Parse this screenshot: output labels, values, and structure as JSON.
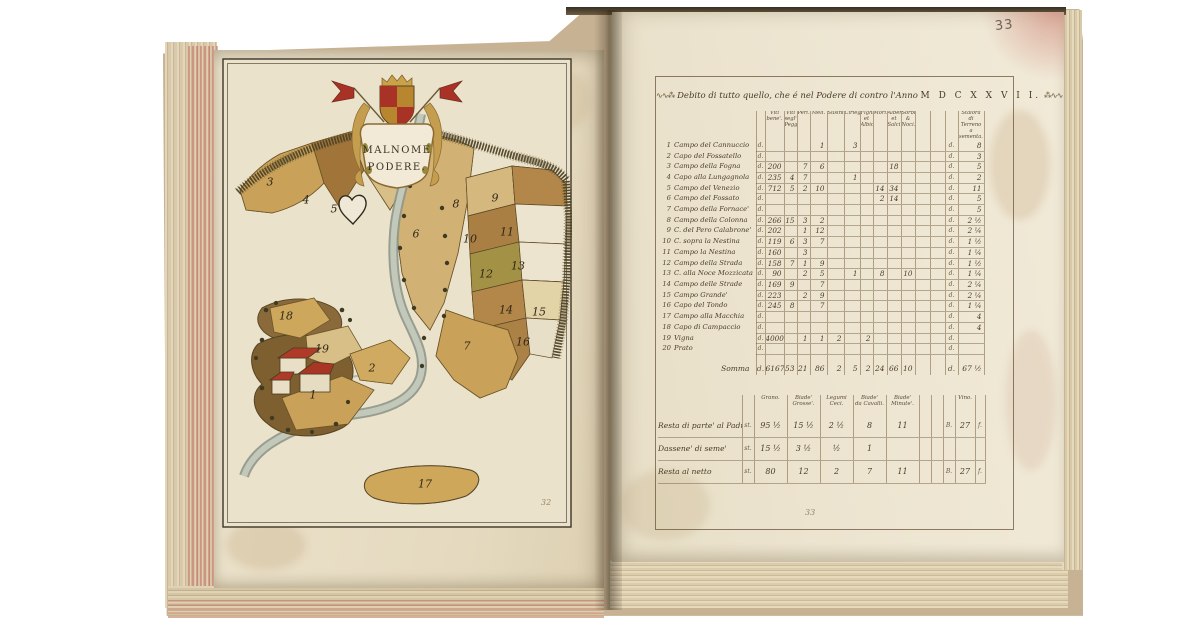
{
  "book": {
    "folio_top_right": "33",
    "left_page_number": "32",
    "right_page_number": "33"
  },
  "map_page": {
    "cartouche": {
      "line1": "MALNOME",
      "line2": "PODERE."
    },
    "field_numbers": [
      {
        "n": "1",
        "x": 91,
        "y": 337
      },
      {
        "n": "2",
        "x": 150,
        "y": 310
      },
      {
        "n": "3",
        "x": 48,
        "y": 124
      },
      {
        "n": "4",
        "x": 84,
        "y": 142
      },
      {
        "n": "5",
        "x": 112,
        "y": 151
      },
      {
        "n": "6",
        "x": 194,
        "y": 176
      },
      {
        "n": "7",
        "x": 245,
        "y": 288
      },
      {
        "n": "8",
        "x": 234,
        "y": 146
      },
      {
        "n": "9",
        "x": 273,
        "y": 140
      },
      {
        "n": "10",
        "x": 248,
        "y": 181
      },
      {
        "n": "11",
        "x": 285,
        "y": 174
      },
      {
        "n": "12",
        "x": 264,
        "y": 216
      },
      {
        "n": "13",
        "x": 296,
        "y": 208
      },
      {
        "n": "14",
        "x": 284,
        "y": 252
      },
      {
        "n": "15",
        "x": 317,
        "y": 254
      },
      {
        "n": "16",
        "x": 301,
        "y": 284
      },
      {
        "n": "17",
        "x": 203,
        "y": 426
      },
      {
        "n": "18",
        "x": 64,
        "y": 258
      },
      {
        "n": "19",
        "x": 100,
        "y": 291
      }
    ]
  },
  "ledger_page": {
    "title": {
      "flourish_left": "∿∿⁂",
      "text": "Debito di tutto quello, che é nel Podere di contro l'Anno",
      "year": "M D C X X V I I.",
      "flourish_right": "⁂∿∿"
    },
    "unit_mark": "d.",
    "columns": [
      "Viti\nbene'.",
      "Viti segl'\nPegg.",
      "Peri.",
      "Meli.",
      "Susini.",
      "Ciriegi.",
      "Fighi, et\nAlbicocchi.",
      "Mori.",
      "Alberi,\net Salci.",
      "Sorbi,\n& Noci.",
      "",
      "Staiora di\nTerreno a\nsementa."
    ],
    "rows": [
      {
        "n": "1",
        "label": "Campo del Cannuccio",
        "v": [
          "",
          "",
          "",
          "1",
          "",
          "3",
          "",
          "",
          "",
          "",
          "",
          "8"
        ]
      },
      {
        "n": "2",
        "label": "Capo del Fossatello",
        "v": [
          "",
          "",
          "",
          "",
          "",
          "",
          "",
          "",
          "",
          "",
          "",
          "3"
        ]
      },
      {
        "n": "3",
        "label": "Campo della Fogna",
        "v": [
          "200",
          "",
          "7",
          "6",
          "",
          "",
          "",
          "",
          "18",
          "",
          "",
          "5"
        ]
      },
      {
        "n": "4",
        "label": "Capo alla Lungagnola",
        "v": [
          "235",
          "4",
          "7",
          "",
          "",
          "1",
          "",
          "",
          "",
          "",
          "",
          "2"
        ]
      },
      {
        "n": "5",
        "label": "Campo del Venezio",
        "v": [
          "712",
          "5",
          "2",
          "10",
          "",
          "",
          "",
          "14",
          "34",
          "",
          "",
          "11"
        ]
      },
      {
        "n": "6",
        "label": "Campo del Fossato",
        "v": [
          "",
          "",
          "",
          "",
          "",
          "",
          "",
          "2",
          "14",
          "",
          "",
          "5"
        ]
      },
      {
        "n": "7",
        "label": "Campo della Fornace'",
        "v": [
          "",
          "",
          "",
          "",
          "",
          "",
          "",
          "",
          "",
          "",
          "",
          "5"
        ]
      },
      {
        "n": "8",
        "label": "Campo della Colonna",
        "v": [
          "266",
          "15",
          "3",
          "2",
          "",
          "",
          "",
          "",
          "",
          "",
          "",
          "2 ½"
        ]
      },
      {
        "n": "9",
        "label": "C. del Pero Calabrone'",
        "v": [
          "202",
          "",
          "1",
          "12",
          "",
          "",
          "",
          "",
          "",
          "",
          "",
          "2 ¼"
        ]
      },
      {
        "n": "10",
        "label": "C. sopra la Nestina",
        "v": [
          "119",
          "6",
          "3",
          "7",
          "",
          "",
          "",
          "",
          "",
          "",
          "",
          "1 ½"
        ]
      },
      {
        "n": "11",
        "label": "Campo la Nestina",
        "v": [
          "160",
          "",
          "3",
          "",
          "",
          "",
          "",
          "",
          "",
          "",
          "",
          "1 ¼"
        ]
      },
      {
        "n": "12",
        "label": "Campo della Strada",
        "v": [
          "158",
          "7",
          "1",
          "9",
          "",
          "",
          "",
          "",
          "",
          "",
          "",
          "1 ½"
        ]
      },
      {
        "n": "13",
        "label": "C. alla Noce Mozzicata",
        "v": [
          "90",
          "",
          "2",
          "5",
          "",
          "1",
          "",
          "8",
          "",
          "10",
          "",
          "1 ¼"
        ]
      },
      {
        "n": "14",
        "label": "Campo delle Strade",
        "v": [
          "169",
          "9",
          "",
          "7",
          "",
          "",
          "",
          "",
          "",
          "",
          "",
          "2 ¼"
        ]
      },
      {
        "n": "15",
        "label": "Campo Grande'",
        "v": [
          "223",
          "",
          "2",
          "9",
          "",
          "",
          "",
          "",
          "",
          "",
          "",
          "2 ¼"
        ]
      },
      {
        "n": "16",
        "label": "Capo del Tondo",
        "v": [
          "245",
          "8",
          "",
          "7",
          "",
          "",
          "",
          "",
          "",
          "",
          "",
          "1 ¼"
        ]
      },
      {
        "n": "17",
        "label": "Campo alla Macchia",
        "v": [
          "",
          "",
          "",
          "",
          "",
          "",
          "",
          "",
          "",
          "",
          "",
          "4"
        ]
      },
      {
        "n": "18",
        "label": "Capo di Campaccio",
        "v": [
          "",
          "",
          "",
          "",
          "",
          "",
          "",
          "",
          "",
          "",
          "",
          "4"
        ]
      },
      {
        "n": "19",
        "label": "Vigna",
        "v": [
          "4000",
          "",
          "1",
          "1",
          "2",
          "",
          "2",
          "",
          "",
          "",
          "",
          ""
        ]
      },
      {
        "n": "20",
        "label": "Prato",
        "v": [
          "",
          "",
          "",
          "",
          "",
          "",
          "",
          "",
          "",
          "",
          "",
          ""
        ]
      }
    ],
    "somma": {
      "label": "Somma",
      "v": [
        "6167",
        "53",
        "21",
        "86",
        "2",
        "5",
        "2",
        "24",
        "66",
        "10",
        "",
        "67 ½"
      ]
    },
    "recap": {
      "unit_mark": "st.",
      "columns": [
        "Grano.",
        "Biade'\nGrosse'.",
        "Legumi\nCeci.",
        "Biade'\nda Cavalli.",
        "Biade'\nMinute'.",
        "Vino."
      ],
      "vino_pre": "B.",
      "vino_suf": "f.",
      "rows": [
        {
          "label": "Resta di parte' al Padrone'",
          "v": [
            "95 ½",
            "15 ½",
            "2 ½",
            "8",
            "11"
          ],
          "vino": "27",
          "show_vino_marks": true
        },
        {
          "label": "Dassene' di seme'",
          "v": [
            "15 ½",
            "3 ½",
            "½",
            "1",
            ""
          ],
          "vino": "",
          "show_vino_marks": false
        },
        {
          "label": "Resta al netto",
          "v": [
            "80",
            "12",
            "2",
            "7",
            "11"
          ],
          "vino": "27",
          "show_vino_marks": true
        }
      ]
    }
  }
}
